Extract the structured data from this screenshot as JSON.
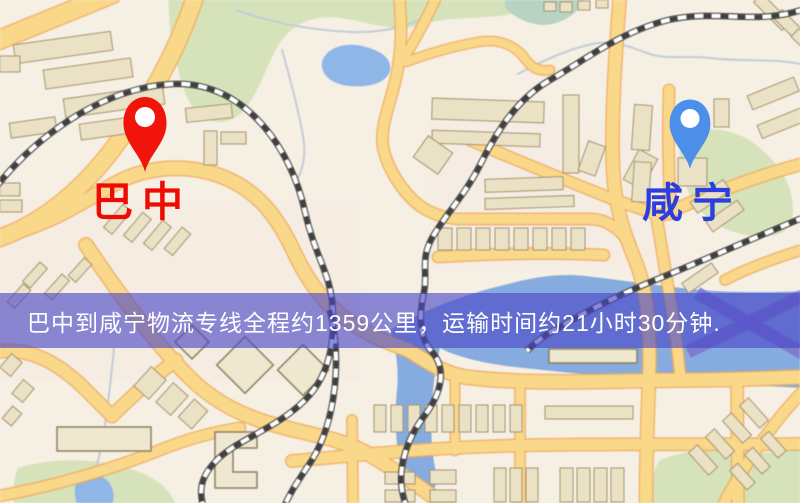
{
  "map": {
    "origin": {
      "label": "巴中",
      "label_color": "#ee0b04",
      "pin_color": "#f0140a"
    },
    "destination": {
      "label": "咸宁",
      "label_color": "#2c3ede",
      "pin_color": "#4c8feb"
    }
  },
  "banner": {
    "text": "巴中到咸宁物流专线全程约1359公里，运输时间约21小时30分钟.",
    "background_color": "#4846c6",
    "text_color": "#ffffff"
  }
}
